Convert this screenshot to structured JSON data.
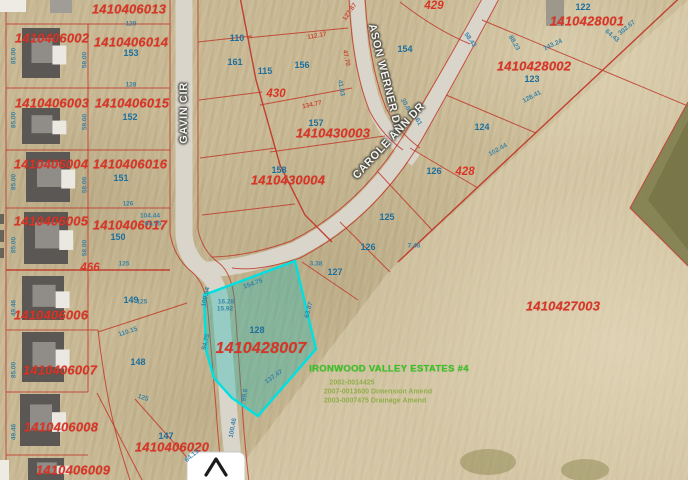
{
  "map": {
    "type": "gis-parcel-map",
    "highlighted_parcel_id": "1410428007",
    "colors": {
      "parcel_id": "#d93425",
      "lot_number": "#1d6f9e",
      "dim_blue": "#2e7ea6",
      "dim_red": "#c8402f",
      "street_text": "#f4f3ee",
      "road_fill": "#d9d5cb",
      "line_red": "#c0392b",
      "highlight_stroke": "#00e0e0",
      "highlight_fill": "rgba(0,185,185,0.30)",
      "green_bold": "#35c520",
      "green_faint": "#86a93c"
    },
    "streets": [
      {
        "name": "GAVIN CIR",
        "x": 184,
        "y": 113,
        "rot": -90
      },
      {
        "name": "ASON WERNER DR",
        "x": 385,
        "y": 78,
        "rot": 76
      },
      {
        "name": "CAROLE ANN DR",
        "x": 389,
        "y": 141,
        "rot": -47
      }
    ],
    "labels": {
      "parcel_ids": [
        {
          "text": "1410406013",
          "x": 129,
          "y": 9
        },
        {
          "text": "1410406002",
          "x": 52,
          "y": 38
        },
        {
          "text": "1410406014",
          "x": 131,
          "y": 42
        },
        {
          "text": "1410406003",
          "x": 52,
          "y": 103
        },
        {
          "text": "1410406015",
          "x": 132,
          "y": 103
        },
        {
          "text": "1410406004",
          "x": 51,
          "y": 164
        },
        {
          "text": "1410406016",
          "x": 130,
          "y": 164
        },
        {
          "text": "1410406005",
          "x": 51,
          "y": 221
        },
        {
          "text": "1410406017",
          "x": 130,
          "y": 225
        },
        {
          "text": "1410406006",
          "x": 51,
          "y": 315
        },
        {
          "text": "1410406007",
          "x": 60,
          "y": 370
        },
        {
          "text": "1410406008",
          "x": 61,
          "y": 427
        },
        {
          "text": "1410406009",
          "x": 73,
          "y": 470
        },
        {
          "text": "1410406020",
          "x": 172,
          "y": 447
        },
        {
          "text": "1410430003",
          "x": 333,
          "y": 133
        },
        {
          "text": "1410430004",
          "x": 288,
          "y": 180
        },
        {
          "text": "1410428001",
          "x": 587,
          "y": 21
        },
        {
          "text": "1410428002",
          "x": 534,
          "y": 66
        },
        {
          "text": "1410427003",
          "x": 563,
          "y": 306
        },
        {
          "text": "1410428007",
          "x": 261,
          "y": 349,
          "big": true
        }
      ],
      "block_numbers": [
        {
          "text": "429",
          "x": 434,
          "y": 6
        },
        {
          "text": "430",
          "x": 276,
          "y": 94
        },
        {
          "text": "428",
          "x": 465,
          "y": 172
        },
        {
          "text": "466",
          "x": 90,
          "y": 268
        }
      ],
      "lot_numbers": [
        {
          "text": "153",
          "x": 131,
          "y": 53
        },
        {
          "text": "152",
          "x": 130,
          "y": 117
        },
        {
          "text": "151",
          "x": 121,
          "y": 178
        },
        {
          "text": "150",
          "x": 118,
          "y": 237
        },
        {
          "text": "149",
          "x": 131,
          "y": 300
        },
        {
          "text": "148",
          "x": 138,
          "y": 362
        },
        {
          "text": "147",
          "x": 166,
          "y": 436
        },
        {
          "text": "128",
          "x": 257,
          "y": 330
        },
        {
          "text": "127",
          "x": 335,
          "y": 272
        },
        {
          "text": "126",
          "x": 434,
          "y": 171
        },
        {
          "text": "125",
          "x": 387,
          "y": 217
        },
        {
          "text": "126",
          "x": 368,
          "y": 247
        },
        {
          "text": "124",
          "x": 482,
          "y": 127
        },
        {
          "text": "123",
          "x": 532,
          "y": 79
        },
        {
          "text": "122",
          "x": 583,
          "y": 7
        },
        {
          "text": "156",
          "x": 302,
          "y": 65
        },
        {
          "text": "157",
          "x": 316,
          "y": 123
        },
        {
          "text": "158",
          "x": 279,
          "y": 170
        },
        {
          "text": "154",
          "x": 405,
          "y": 49
        },
        {
          "text": "161",
          "x": 235,
          "y": 62
        },
        {
          "text": "110",
          "x": 237,
          "y": 38
        },
        {
          "text": "115",
          "x": 265,
          "y": 71
        }
      ],
      "dimensions": [
        {
          "text": "85.00",
          "x": 14,
          "y": 56,
          "rot": -90
        },
        {
          "text": "85.00",
          "x": 14,
          "y": 120,
          "rot": -90
        },
        {
          "text": "85.00",
          "x": 14,
          "y": 182,
          "rot": -90
        },
        {
          "text": "85.00",
          "x": 14,
          "y": 245,
          "rot": -90
        },
        {
          "text": "49.46",
          "x": 14,
          "y": 308,
          "rot": -90
        },
        {
          "text": "85.00",
          "x": 14,
          "y": 370,
          "rot": -90
        },
        {
          "text": "49.46",
          "x": 14,
          "y": 432,
          "rot": -90
        },
        {
          "text": "58.00",
          "x": 85,
          "y": 60,
          "rot": -90
        },
        {
          "text": "58.00",
          "x": 85,
          "y": 122,
          "rot": -90
        },
        {
          "text": "58.00",
          "x": 85,
          "y": 185,
          "rot": -90
        },
        {
          "text": "58.00",
          "x": 85,
          "y": 248,
          "rot": -90
        },
        {
          "text": "129",
          "x": 131,
          "y": 24,
          "rot": 0
        },
        {
          "text": "128",
          "x": 131,
          "y": 85,
          "rot": 0
        },
        {
          "text": "126",
          "x": 128,
          "y": 204,
          "rot": 0
        },
        {
          "text": "125",
          "x": 124,
          "y": 264,
          "rot": 0
        },
        {
          "text": "125",
          "x": 142,
          "y": 302,
          "rot": 0
        },
        {
          "text": "110.15",
          "x": 128,
          "y": 332,
          "rot": -18
        },
        {
          "text": "125",
          "x": 143,
          "y": 398,
          "rot": 18
        },
        {
          "text": "104.44",
          "x": 150,
          "y": 216,
          "rot": 0
        },
        {
          "text": "64.75",
          "x": 153,
          "y": 224,
          "rot": 0
        },
        {
          "text": "112.17",
          "x": 317,
          "y": 36,
          "rot": -10,
          "color": "red"
        },
        {
          "text": "134.77",
          "x": 312,
          "y": 105,
          "rot": -12,
          "color": "red"
        },
        {
          "text": "47.70",
          "x": 346,
          "y": 58,
          "rot": 78,
          "color": "red"
        },
        {
          "text": "41.03",
          "x": 341,
          "y": 88,
          "rot": 80
        },
        {
          "text": "127.87",
          "x": 350,
          "y": 12,
          "rot": -55,
          "color": "red"
        },
        {
          "text": "3.38",
          "x": 316,
          "y": 264,
          "rot": 0
        },
        {
          "text": "154.75",
          "x": 253,
          "y": 284,
          "rot": -20
        },
        {
          "text": "16.28",
          "x": 226,
          "y": 302,
          "rot": 0
        },
        {
          "text": "15.92",
          "x": 225,
          "y": 309,
          "rot": 0
        },
        {
          "text": "94.75",
          "x": 206,
          "y": 342,
          "rot": -75
        },
        {
          "text": "63.87",
          "x": 309,
          "y": 310,
          "rot": -75
        },
        {
          "text": "137.47",
          "x": 274,
          "y": 377,
          "rot": -35
        },
        {
          "text": "99.6",
          "x": 245,
          "y": 395,
          "rot": -80
        },
        {
          "text": "100.54",
          "x": 206,
          "y": 297,
          "rot": -78
        },
        {
          "text": "143.24",
          "x": 553,
          "y": 45,
          "rot": -25
        },
        {
          "text": "88.23",
          "x": 514,
          "y": 43,
          "rot": 60
        },
        {
          "text": "302.67",
          "x": 627,
          "y": 28,
          "rot": -40
        },
        {
          "text": "58.43",
          "x": 470,
          "y": 40,
          "rot": 55
        },
        {
          "text": "64.43",
          "x": 612,
          "y": 36,
          "rot": 40
        },
        {
          "text": "128.41",
          "x": 532,
          "y": 97,
          "rot": -28
        },
        {
          "text": "102.44",
          "x": 498,
          "y": 150,
          "rot": -30
        },
        {
          "text": "30.65",
          "x": 406,
          "y": 106,
          "rot": 60
        },
        {
          "text": "30.61",
          "x": 416,
          "y": 118,
          "rot": 60
        },
        {
          "text": "7.48",
          "x": 414,
          "y": 246,
          "rot": 0
        },
        {
          "text": "64.13",
          "x": 192,
          "y": 456,
          "rot": -40
        },
        {
          "text": "100.46",
          "x": 233,
          "y": 428,
          "rot": -80
        }
      ]
    },
    "annotation": {
      "title": "IRONWOOD VALLEY ESTATES #4",
      "lines": [
        "2002-0014425",
        "2007-0013600 Dimension Amend",
        "2003-0007475 Drainage Amend"
      ]
    },
    "houses": [
      {
        "x": 22,
        "y": 28,
        "w": 38,
        "h": 50
      },
      {
        "x": 22,
        "y": 108,
        "w": 38,
        "h": 36
      },
      {
        "x": 26,
        "y": 152,
        "w": 44,
        "h": 50
      },
      {
        "x": 24,
        "y": 212,
        "w": 44,
        "h": 52
      },
      {
        "x": 22,
        "y": 276,
        "w": 42,
        "h": 44
      },
      {
        "x": 22,
        "y": 332,
        "w": 42,
        "h": 50
      },
      {
        "x": 20,
        "y": 394,
        "w": 40,
        "h": 52
      },
      {
        "x": 28,
        "y": 458,
        "w": 36,
        "h": 22
      }
    ],
    "north_arrow": {
      "shape": "chevron-up"
    }
  }
}
